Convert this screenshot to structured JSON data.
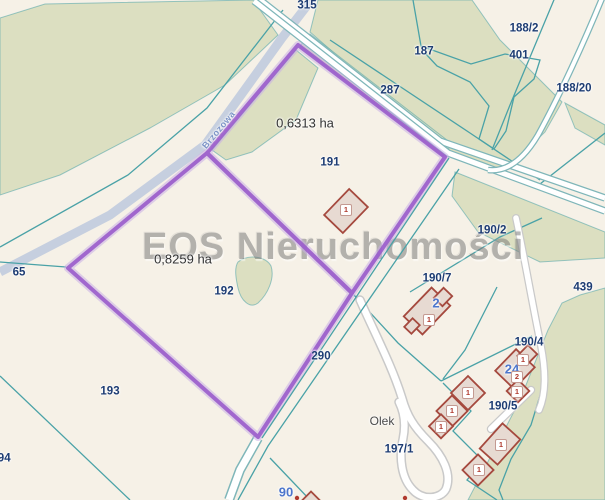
{
  "watermark": {
    "text": "EOS Nieruchomości"
  },
  "street_label": {
    "text": "Brzozowa",
    "x": 219,
    "y": 130,
    "rotate": -50
  },
  "labels": {
    "parcels": [
      {
        "text": "315",
        "x": 307,
        "y": 6
      },
      {
        "text": "188/2",
        "x": 524,
        "y": 29
      },
      {
        "text": "187",
        "x": 424,
        "y": 52
      },
      {
        "text": "401",
        "x": 519,
        "y": 56
      },
      {
        "text": "287",
        "x": 390,
        "y": 91
      },
      {
        "text": "188/20",
        "x": 574,
        "y": 89
      },
      {
        "text": "191",
        "x": 330,
        "y": 163
      },
      {
        "text": "190/2",
        "x": 492,
        "y": 231
      },
      {
        "text": "190/7",
        "x": 437,
        "y": 279
      },
      {
        "text": "439",
        "x": 583,
        "y": 288
      },
      {
        "text": "65",
        "x": 19,
        "y": 273
      },
      {
        "text": "192",
        "x": 224,
        "y": 292
      },
      {
        "text": "290",
        "x": 321,
        "y": 357
      },
      {
        "text": "190/4",
        "x": 529,
        "y": 343
      },
      {
        "text": "190/5",
        "x": 503,
        "y": 407
      },
      {
        "text": "193",
        "x": 110,
        "y": 392
      },
      {
        "text": "197/1",
        "x": 399,
        "y": 450
      },
      {
        "text": "194",
        "x": 1,
        "y": 459
      }
    ],
    "areas": [
      {
        "text": "0,6313 ha",
        "x": 305,
        "y": 123
      },
      {
        "text": "0,8259 ha",
        "x": 183,
        "y": 259
      }
    ],
    "addresses": [
      {
        "text": "2",
        "x": 436,
        "y": 303
      },
      {
        "text": "24",
        "x": 512,
        "y": 369
      },
      {
        "text": "90",
        "x": 286,
        "y": 492
      }
    ],
    "places": [
      {
        "text": "Olek",
        "x": 382,
        "y": 421
      }
    ]
  },
  "building_badges": [
    {
      "text": "1",
      "x": 346,
      "y": 210
    },
    {
      "text": "1",
      "x": 429,
      "y": 320
    },
    {
      "text": "1",
      "x": 523,
      "y": 360
    },
    {
      "text": "2",
      "x": 517,
      "y": 377
    },
    {
      "text": "1",
      "x": 517,
      "y": 392
    },
    {
      "text": "1",
      "x": 468,
      "y": 393
    },
    {
      "text": "1",
      "x": 452,
      "y": 411
    },
    {
      "text": "1",
      "x": 441,
      "y": 427
    },
    {
      "text": "1",
      "x": 501,
      "y": 445
    },
    {
      "text": "1",
      "x": 479,
      "y": 470
    }
  ],
  "selected_parcels": [
    {
      "number": "192",
      "area": "0,8259 ha"
    },
    {
      "number": "191",
      "area": "0,6313 ha"
    }
  ],
  "colors": {
    "background": "#f6f1e7",
    "green": "#dcdfc1",
    "teal": "#4aa2a7",
    "roadCasing": "#7fb6b9",
    "grayRoad": "#c6cfdf",
    "purple": "#9a5ccb",
    "purpleHalo": "#c9aee6",
    "navy": "#1d3c73",
    "buildingFill": "#e7dad2",
    "buildingStroke": "#a5493e",
    "addressBlue": "#4d76cc",
    "areaText": "#333333",
    "watermark": "#7d7d7d"
  }
}
